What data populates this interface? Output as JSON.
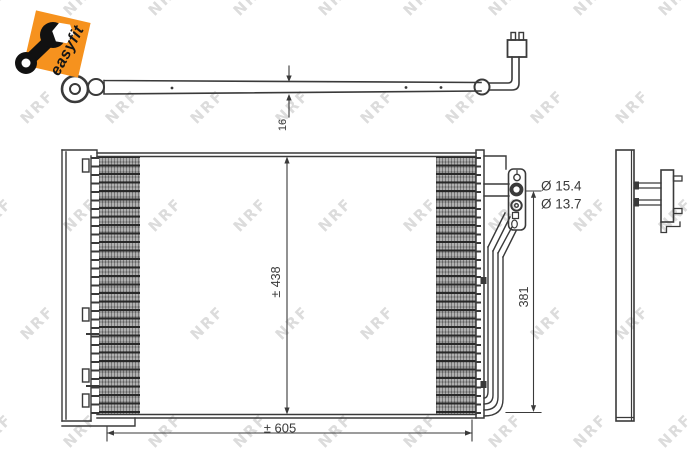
{
  "badge": {
    "label": "easyfit",
    "color": "#f6921e"
  },
  "watermark": {
    "text": "NRF",
    "color": "#dcdcdc"
  },
  "pipe": {
    "diameter_label": "16"
  },
  "condenser": {
    "height_label": "± 438",
    "width_label": "± 605",
    "side_height_label": "381"
  },
  "connections": {
    "port_top_label": "Ø 15.4",
    "port_bottom_label": "Ø 13.7"
  },
  "colors": {
    "line": "#3a3a3a"
  }
}
